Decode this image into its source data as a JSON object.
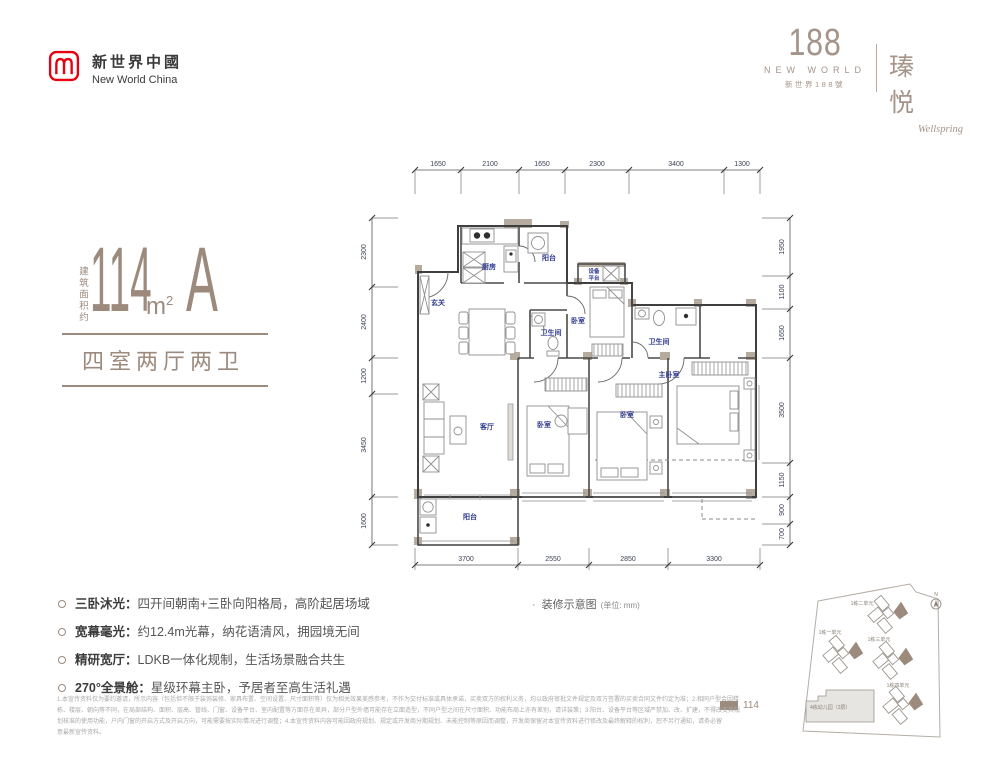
{
  "brand": {
    "logo_cn": "新世界中國",
    "logo_en": "New World China",
    "logo_color": "#e60012"
  },
  "project": {
    "number": "188",
    "name_en": "NEW WORLD",
    "name_cn": "新世界188號",
    "title_cn": "瑧 悦",
    "title_en": "Wellspring",
    "accent_color": "#9c8a7d"
  },
  "unit": {
    "area_prefix": "建筑面积约",
    "area_value": "114",
    "area_unit": "m",
    "area_sup": "2",
    "type_letter": "A",
    "layout": "四室两厅两卫"
  },
  "plan": {
    "caption": "装修示意图",
    "caption_unit": "(单位: mm)",
    "dims_top": [
      "1650",
      "2100",
      "1650",
      "2300",
      "3400",
      "1300"
    ],
    "dims_bottom": [
      "3700",
      "2550",
      "2850",
      "3300"
    ],
    "dims_left": [
      "2300",
      "2400",
      "1200",
      "3450",
      "1600"
    ],
    "dims_right": [
      "1950",
      "1100",
      "1650",
      "3500",
      "1150",
      "900",
      "700"
    ],
    "rooms": {
      "entry": "玄关",
      "kitchen": "厨房",
      "balcony_top": "阳台",
      "equipment_1": "设备",
      "equipment_2": "平台",
      "bath_1": "卫生间",
      "bedroom_top": "卧室",
      "bath_2": "卫生间",
      "master": "主卧室",
      "living": "客厅",
      "bedroom_1": "卧室",
      "bedroom_2": "卧室",
      "balcony_bottom": "阳台"
    }
  },
  "features": [
    {
      "title": "三卧沐光：",
      "text": "四开间朝南+三卧向阳格局，高阶起居场域"
    },
    {
      "title": "宽幕毫光：",
      "text": "约12.4m光幕，纳花语清风，拥园境无间"
    },
    {
      "title": "精研宽厅：",
      "text": "LDKB一体化规制，生活场景融合共生"
    },
    {
      "title": "270°全景舱：",
      "text": "星级环幕主卧，予居者至高生活礼遇"
    }
  ],
  "site_plan": {
    "buildings": [
      "1栋二单元",
      "1栋一单元",
      "1栋三单元",
      "1栋四单元"
    ],
    "kindergarten": "4栋幼儿园（3层）",
    "compass": "N",
    "legend_value": "114",
    "legend_color": "#9c8a7d"
  },
  "disclaimer": {
    "lines": [
      "1.本宣传资料仅为要约邀请，所示内容（包括但不限于装饰装修、家具布置、空间设置、尺寸面积等）仅为相关效果美感参考，不作为交付标准或具体承诺，买卖双方的权利义务，均以政府审批文件规定及双方签署的买卖合同文件约定为准；2.相同户型会因楼",
      "栋、楼层、朝向等不同，在局部结构、面积、层高、管线、门窗、设备平台、室内配置等方面存在差异，部分户型外墙可能存在立面造型，不同户型之间在尺寸面积、功能布局上亦有差别，请详装策；3.阳台、设备平台等区域严禁加、改、扩建，不得改变其规",
      "划核准的使用功能，户内门窗的开启方式及开启方向，可能需要按实际情况进行调整；4.本宣传资料内容可能因政府规划、规定或开发商分期规划、未能控制等原因而调整，开发商保留对本宣传资料进行修改及最终解释的权利，恕不另行通知，请务必留",
      "意最新宣传资料。"
    ]
  }
}
